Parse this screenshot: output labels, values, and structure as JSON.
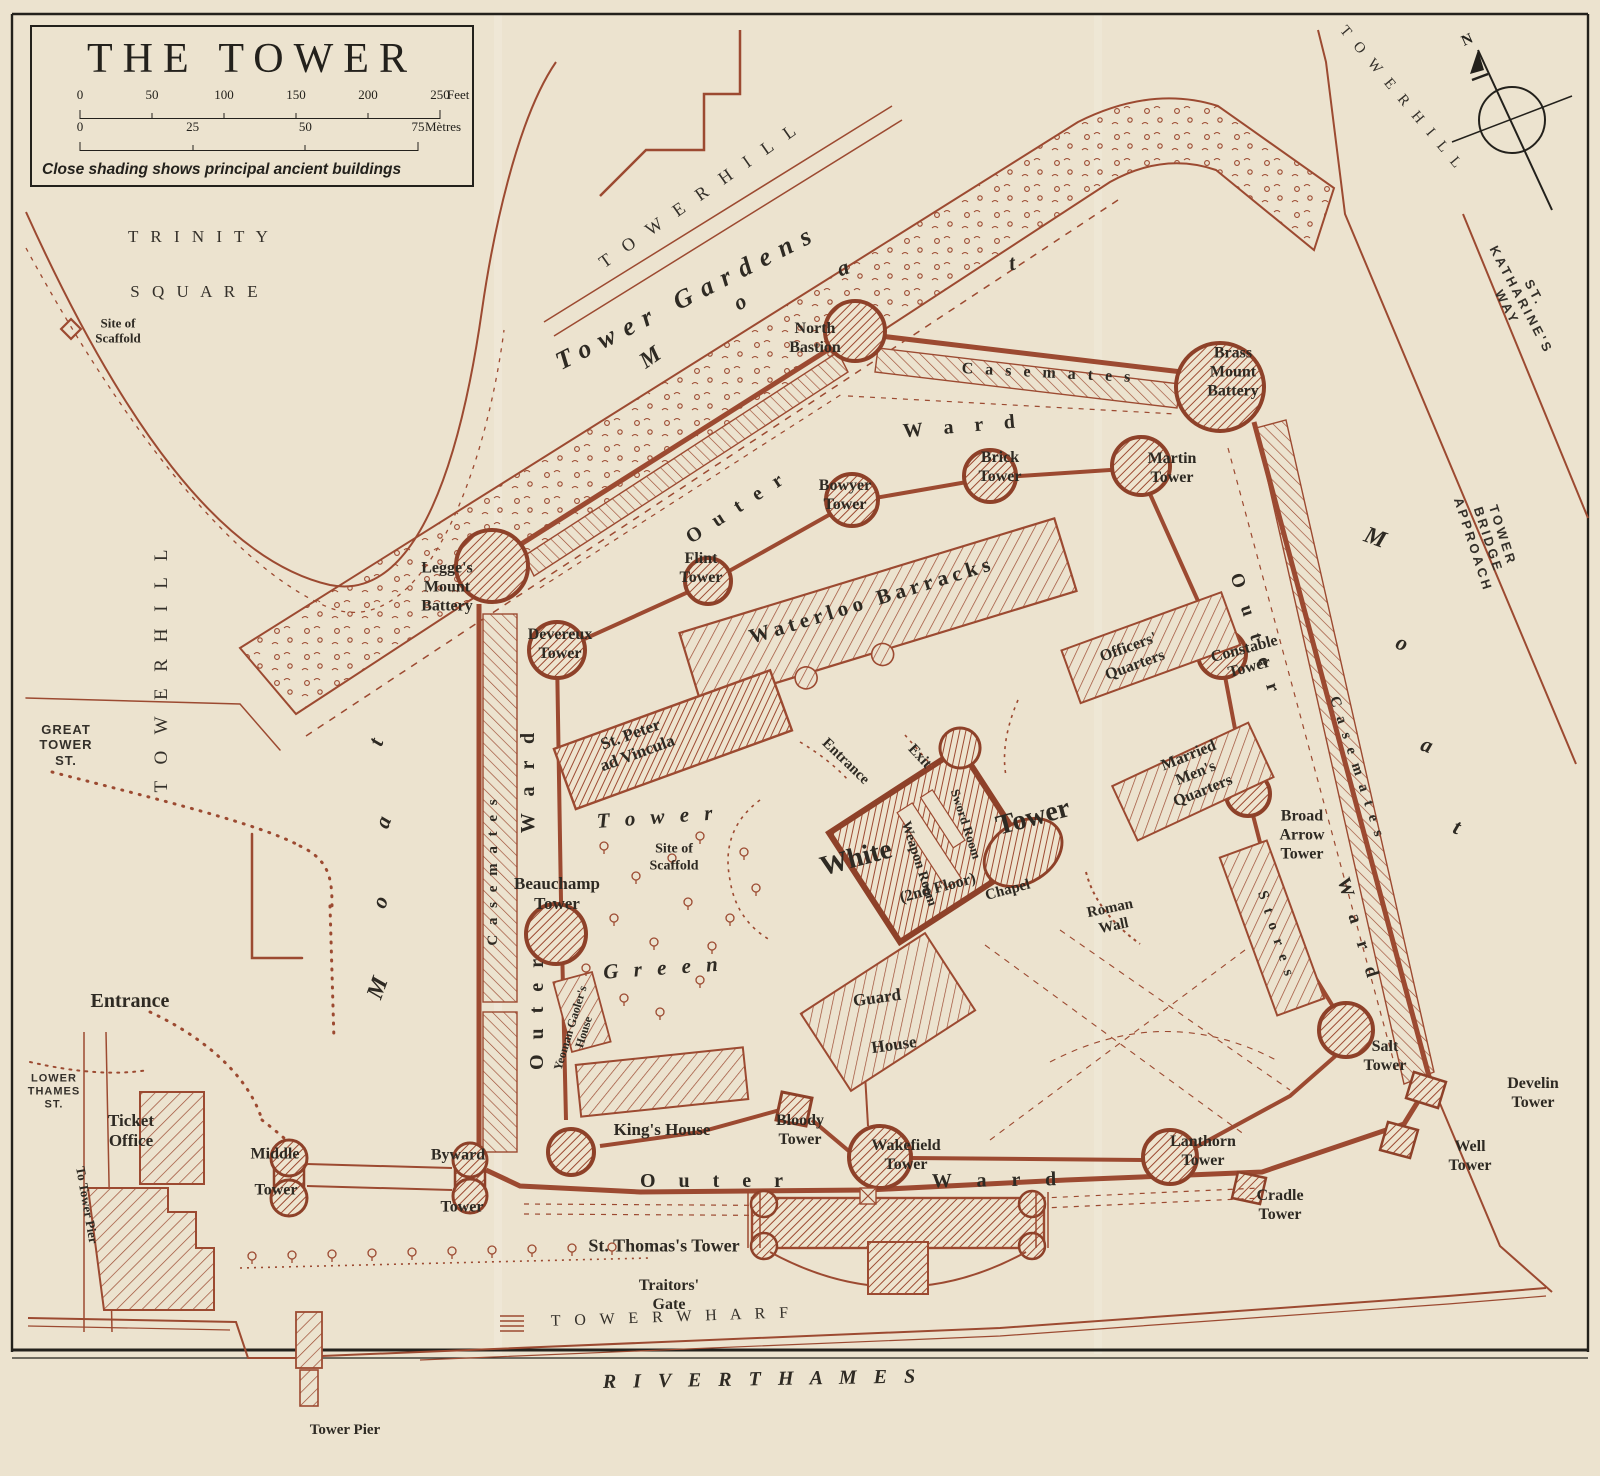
{
  "title_block": {
    "title": "THE TOWER",
    "feet_ticks": [
      "0",
      "50",
      "100",
      "150",
      "200",
      "250"
    ],
    "feet_unit": "Feet",
    "metre_ticks": [
      "0",
      "25",
      "50",
      "75"
    ],
    "metre_unit": "Mètres",
    "legend": "Close shading shows principal ancient buildings"
  },
  "compass": {
    "north": "N"
  },
  "colors": {
    "paper": "#ece3cf",
    "map_ink": "#9c4a31",
    "label_ink": "#2e2a23",
    "frame_ink": "#23211c"
  },
  "map": {
    "labels": [
      {
        "id": "trinity-square-line1",
        "text": "T R I N I T Y",
        "x": 200,
        "y": 237,
        "rot": 0,
        "size": 17,
        "cls": "caps",
        "ls": 4
      },
      {
        "id": "trinity-square-line2",
        "text": "S Q U A R E",
        "x": 196,
        "y": 292,
        "rot": 0,
        "size": 17,
        "cls": "caps",
        "ls": 4
      },
      {
        "id": "tower-hill-west",
        "text": "T O W E R    H I L L",
        "x": 162,
        "y": 668,
        "rot": -90,
        "size": 19,
        "cls": "caps",
        "ls": 6
      },
      {
        "id": "tower-hill-northwest",
        "text": "T O W E R   H I L L",
        "x": 700,
        "y": 195,
        "rot": -35,
        "size": 18,
        "cls": "caps",
        "ls": 6
      },
      {
        "id": "tower-hill-northeast",
        "text": "T O W E R   H I L L",
        "x": 1401,
        "y": 99,
        "rot": 50,
        "size": 15,
        "cls": "caps",
        "ls": 4
      },
      {
        "id": "st-katharines-way",
        "text": "ST. KATHARINE'S WAY",
        "x": 1521,
        "y": 300,
        "rot": 62,
        "size": 13,
        "cls": "sans",
        "ls": 3
      },
      {
        "id": "tower-bridge-approach",
        "text": "TOWER BRIDGE APPROACH",
        "x": 1488,
        "y": 540,
        "rot": 72,
        "size": 13,
        "cls": "sans",
        "ls": 3
      },
      {
        "id": "tower-wharf",
        "text": "T O W E R    W H A R F",
        "x": 672,
        "y": 1318,
        "rot": -2,
        "size": 16,
        "cls": "caps",
        "ls": 5
      },
      {
        "id": "river-thames",
        "text": "R I V E R     T H A M E S",
        "x": 762,
        "y": 1380,
        "rot": -1,
        "size": 20,
        "cls": "itcaps",
        "ls": 6
      },
      {
        "id": "great-tower-st",
        "text": "GREAT\nTOWER\nST.",
        "x": 66,
        "y": 745,
        "rot": 0,
        "size": 13,
        "cls": "sans",
        "ls": 1
      },
      {
        "id": "lower-thames-st",
        "text": "LOWER\nTHAMES\nST.",
        "x": 54,
        "y": 1092,
        "rot": 0,
        "size": 11,
        "cls": "sans",
        "ls": 1
      },
      {
        "id": "tower-gardens",
        "text": "Tower Gardens",
        "x": 688,
        "y": 297,
        "rot": -27,
        "size": 26,
        "cls": "it",
        "ls": 10
      },
      {
        "id": "moat-north-m",
        "text": "M",
        "x": 650,
        "y": 357,
        "rot": -35,
        "size": 23,
        "cls": "it"
      },
      {
        "id": "moat-north-o",
        "text": "o",
        "x": 740,
        "y": 302,
        "rot": -30,
        "size": 22,
        "cls": "it"
      },
      {
        "id": "moat-north-a",
        "text": "a",
        "x": 843,
        "y": 268,
        "rot": -20,
        "size": 22,
        "cls": "it"
      },
      {
        "id": "moat-north-t",
        "text": "t",
        "x": 1012,
        "y": 263,
        "rot": -10,
        "size": 22,
        "cls": "it"
      },
      {
        "id": "moat-west-t",
        "text": "t",
        "x": 376,
        "y": 742,
        "rot": -70,
        "size": 22,
        "cls": "it"
      },
      {
        "id": "moat-west-a",
        "text": "a",
        "x": 383,
        "y": 822,
        "rot": -70,
        "size": 22,
        "cls": "it"
      },
      {
        "id": "moat-west-o",
        "text": "o",
        "x": 380,
        "y": 902,
        "rot": -70,
        "size": 22,
        "cls": "it"
      },
      {
        "id": "moat-west-m",
        "text": "M",
        "x": 378,
        "y": 988,
        "rot": -70,
        "size": 24,
        "cls": "it"
      },
      {
        "id": "moat-east-m",
        "text": "M",
        "x": 1375,
        "y": 538,
        "rot": 20,
        "size": 24,
        "cls": "it"
      },
      {
        "id": "moat-east-o",
        "text": "o",
        "x": 1402,
        "y": 643,
        "rot": 20,
        "size": 22,
        "cls": "it"
      },
      {
        "id": "moat-east-a",
        "text": "a",
        "x": 1427,
        "y": 745,
        "rot": 20,
        "size": 22,
        "cls": "it"
      },
      {
        "id": "moat-east-t",
        "text": "t",
        "x": 1457,
        "y": 827,
        "rot": 20,
        "size": 22,
        "cls": "it"
      },
      {
        "id": "tower-green-word1",
        "text": "T o w e r",
        "x": 657,
        "y": 817,
        "rot": -4,
        "size": 21,
        "cls": "it",
        "ls": 5
      },
      {
        "id": "tower-green-word2",
        "text": "G r e e n",
        "x": 663,
        "y": 968,
        "rot": -4,
        "size": 21,
        "cls": "it",
        "ls": 5
      },
      {
        "id": "outer-ward-north-outer",
        "text": "O u t e r",
        "x": 737,
        "y": 508,
        "rot": -33,
        "size": 20,
        "cls": "sp",
        "ls": 5
      },
      {
        "id": "outer-ward-north-ward",
        "text": "W a r d",
        "x": 963,
        "y": 427,
        "rot": -5,
        "size": 20,
        "cls": "sp",
        "ls": 8
      },
      {
        "id": "outer-ward-west-ward",
        "text": "W a r d",
        "x": 529,
        "y": 780,
        "rot": -90,
        "size": 20,
        "cls": "sp",
        "ls": 6
      },
      {
        "id": "outer-ward-west-outer",
        "text": "O u t e r",
        "x": 538,
        "y": 1012,
        "rot": -90,
        "size": 20,
        "cls": "sp",
        "ls": 5
      },
      {
        "id": "outer-ward-south-outer",
        "text": "O u t e r",
        "x": 716,
        "y": 1182,
        "rot": 0,
        "size": 20,
        "cls": "sp",
        "ls": 9
      },
      {
        "id": "outer-ward-south-ward",
        "text": "W a r d",
        "x": 999,
        "y": 1181,
        "rot": -1,
        "size": 20,
        "cls": "sp",
        "ls": 10
      },
      {
        "id": "outer-ward-east-outer",
        "text": "O u t e r",
        "x": 1255,
        "y": 636,
        "rot": 72,
        "size": 19,
        "cls": "sp",
        "ls": 7
      },
      {
        "id": "outer-ward-east-ward",
        "text": "W a r d",
        "x": 1358,
        "y": 931,
        "rot": 73,
        "size": 19,
        "cls": "sp",
        "ls": 7
      },
      {
        "id": "casemates-north",
        "text": "C a s e m a t e s",
        "x": 1048,
        "y": 374,
        "rot": 3,
        "size": 16,
        "cls": "sp",
        "ls": 4
      },
      {
        "id": "casemates-west",
        "text": "C a s e m a t e s",
        "x": 494,
        "y": 871,
        "rot": -90,
        "size": 15,
        "cls": "sp",
        "ls": 3
      },
      {
        "id": "casemates-east",
        "text": "C a s e m a t e s",
        "x": 1356,
        "y": 768,
        "rot": 72,
        "size": 15,
        "cls": "sp",
        "ls": 3
      },
      {
        "id": "stores",
        "text": "S t o r e s",
        "x": 1275,
        "y": 935,
        "rot": 72,
        "size": 15,
        "cls": "sp",
        "ls": 3
      },
      {
        "id": "site-of-scaffold-trinity",
        "text": "Site of\nScaffold",
        "x": 118,
        "y": 331,
        "rot": 0,
        "size": 13,
        "cls": "sm"
      },
      {
        "id": "north-bastion",
        "text": "North\nBastion",
        "x": 815,
        "y": 339,
        "rot": 0,
        "size": 16,
        "cls": "nm"
      },
      {
        "id": "brass-mount-battery",
        "text": "Brass\nMount\nBattery",
        "x": 1233,
        "y": 373,
        "rot": 0,
        "size": 16,
        "cls": "nm"
      },
      {
        "id": "legges-mount-battery",
        "text": "Legge's\nMount\nBattery",
        "x": 447,
        "y": 588,
        "rot": 0,
        "size": 16,
        "cls": "nm"
      },
      {
        "id": "devereux-tower",
        "text": "Devereux\nTower",
        "x": 560,
        "y": 645,
        "rot": 0,
        "size": 16,
        "cls": "nm"
      },
      {
        "id": "flint-tower",
        "text": "Flint\nTower",
        "x": 701,
        "y": 569,
        "rot": 0,
        "size": 16,
        "cls": "nm"
      },
      {
        "id": "bowyer-tower",
        "text": "Bowyer\nTower",
        "x": 845,
        "y": 496,
        "rot": 0,
        "size": 16,
        "cls": "nm"
      },
      {
        "id": "brick-tower",
        "text": "Brick\nTower",
        "x": 1000,
        "y": 468,
        "rot": 0,
        "size": 16,
        "cls": "nm"
      },
      {
        "id": "martin-tower",
        "text": "Martin\nTower",
        "x": 1172,
        "y": 469,
        "rot": 0,
        "size": 16,
        "cls": "nm"
      },
      {
        "id": "waterloo-barracks",
        "text": "Waterloo   Barracks",
        "x": 872,
        "y": 600,
        "rot": -17,
        "size": 21,
        "cls": "nm",
        "ls": 5
      },
      {
        "id": "officers-quarters",
        "text": "Officers'\nQuarters",
        "x": 1132,
        "y": 657,
        "rot": -20,
        "size": 16,
        "cls": "nm"
      },
      {
        "id": "constable-tower",
        "text": "Constable\nTower",
        "x": 1247,
        "y": 659,
        "rot": -15,
        "size": 16,
        "cls": "nm"
      },
      {
        "id": "married-mens-quarters",
        "text": "Married\nMen's\nQuarters",
        "x": 1196,
        "y": 774,
        "rot": -22,
        "size": 16,
        "cls": "nm"
      },
      {
        "id": "broad-arrow-tower",
        "text": "Broad\nArrow\nTower",
        "x": 1302,
        "y": 836,
        "rot": 0,
        "size": 16,
        "cls": "nm"
      },
      {
        "id": "roman-wall",
        "text": "Roman\nWall",
        "x": 1112,
        "y": 918,
        "rot": -12,
        "size": 15,
        "cls": "nm"
      },
      {
        "id": "st-peter-ad-vincula",
        "text": "St. Peter\nad Vincula",
        "x": 634,
        "y": 744,
        "rot": -20,
        "size": 17,
        "cls": "nm"
      },
      {
        "id": "beauchamp-tower",
        "text": "Beauchamp\nTower",
        "x": 557,
        "y": 894,
        "rot": 0,
        "size": 17,
        "cls": "nm"
      },
      {
        "id": "site-of-scaffold-green",
        "text": "Site of\nScaffold",
        "x": 674,
        "y": 858,
        "rot": 0,
        "size": 14,
        "cls": "sm"
      },
      {
        "id": "yeoman-gaolers-house",
        "text": "Yeoman Gaoler's\nHouse",
        "x": 577,
        "y": 1030,
        "rot": -73,
        "size": 12,
        "cls": "sm"
      },
      {
        "id": "white-tower-word1",
        "text": "White",
        "x": 856,
        "y": 858,
        "rot": -15,
        "size": 28,
        "cls": "nm"
      },
      {
        "id": "white-tower-word2",
        "text": "Tower",
        "x": 1033,
        "y": 817,
        "rot": -15,
        "size": 28,
        "cls": "nm"
      },
      {
        "id": "white-tower-floor",
        "text": "(2nd Floor)",
        "x": 938,
        "y": 889,
        "rot": -15,
        "size": 16,
        "cls": "nm"
      },
      {
        "id": "weapon-room",
        "text": "Weapon Room",
        "x": 918,
        "y": 864,
        "rot": 72,
        "size": 14,
        "cls": "sm"
      },
      {
        "id": "sword-room",
        "text": "Sword Room",
        "x": 966,
        "y": 824,
        "rot": 72,
        "size": 13,
        "cls": "sm"
      },
      {
        "id": "chapel",
        "text": "Chapel",
        "x": 1008,
        "y": 891,
        "rot": -15,
        "size": 15,
        "cls": "nm"
      },
      {
        "id": "white-tower-entrance",
        "text": "Entrance",
        "x": 845,
        "y": 762,
        "rot": 44,
        "size": 15,
        "cls": "nm"
      },
      {
        "id": "white-tower-exit",
        "text": "Exit",
        "x": 919,
        "y": 757,
        "rot": 47,
        "size": 15,
        "cls": "nm"
      },
      {
        "id": "guard-house-word1",
        "text": "Guard",
        "x": 877,
        "y": 998,
        "rot": -8,
        "size": 17,
        "cls": "nm"
      },
      {
        "id": "guard-house-word2",
        "text": "House",
        "x": 894,
        "y": 1045,
        "rot": -8,
        "size": 17,
        "cls": "nm"
      },
      {
        "id": "kings-house",
        "text": "King's House",
        "x": 662,
        "y": 1130,
        "rot": 0,
        "size": 17,
        "cls": "nm"
      },
      {
        "id": "bloody-tower",
        "text": "Bloody\nTower",
        "x": 800,
        "y": 1131,
        "rot": 0,
        "size": 16,
        "cls": "nm"
      },
      {
        "id": "wakefield-tower",
        "text": "Wakefield\nTower",
        "x": 906,
        "y": 1156,
        "rot": 0,
        "size": 16,
        "cls": "nm"
      },
      {
        "id": "lanthorn-tower",
        "text": "Lanthorn\nTower",
        "x": 1203,
        "y": 1152,
        "rot": 0,
        "size": 16,
        "cls": "nm"
      },
      {
        "id": "salt-tower",
        "text": "Salt\nTower",
        "x": 1385,
        "y": 1057,
        "rot": 0,
        "size": 16,
        "cls": "nm"
      },
      {
        "id": "develin-tower",
        "text": "Develin\nTower",
        "x": 1533,
        "y": 1094,
        "rot": 0,
        "size": 16,
        "cls": "nm"
      },
      {
        "id": "well-tower",
        "text": "Well\nTower",
        "x": 1470,
        "y": 1157,
        "rot": 0,
        "size": 16,
        "cls": "nm"
      },
      {
        "id": "cradle-tower",
        "text": "Cradle\nTower",
        "x": 1280,
        "y": 1206,
        "rot": 0,
        "size": 16,
        "cls": "nm"
      },
      {
        "id": "st-thomass-tower",
        "text": "St. Thomas's Tower",
        "x": 664,
        "y": 1246,
        "rot": 0,
        "size": 18,
        "cls": "nm"
      },
      {
        "id": "traitors-gate",
        "text": "Traitors'\nGate",
        "x": 669,
        "y": 1296,
        "rot": 0,
        "size": 16,
        "cls": "nm"
      },
      {
        "id": "middle-tower-word1",
        "text": "Middle",
        "x": 275,
        "y": 1155,
        "rot": 0,
        "size": 16,
        "cls": "nm"
      },
      {
        "id": "middle-tower-word2",
        "text": "Tower",
        "x": 276,
        "y": 1191,
        "rot": 0,
        "size": 16,
        "cls": "nm"
      },
      {
        "id": "byward-tower-word1",
        "text": "Byward",
        "x": 458,
        "y": 1156,
        "rot": 0,
        "size": 16,
        "cls": "nm"
      },
      {
        "id": "byward-tower-word2",
        "text": "Tower",
        "x": 462,
        "y": 1208,
        "rot": 0,
        "size": 16,
        "cls": "nm"
      },
      {
        "id": "ticket-office",
        "text": "Ticket\nOffice",
        "x": 131,
        "y": 1131,
        "rot": 0,
        "size": 17,
        "cls": "nm"
      },
      {
        "id": "entrance-west",
        "text": "Entrance",
        "x": 130,
        "y": 1002,
        "rot": 0,
        "size": 20,
        "cls": "nm"
      },
      {
        "id": "to-tower-pier",
        "text": "To Tower Pier",
        "x": 87,
        "y": 1205,
        "rot": 80,
        "size": 13,
        "cls": "nm"
      },
      {
        "id": "tower-pier",
        "text": "Tower Pier",
        "x": 345,
        "y": 1431,
        "rot": 0,
        "size": 15,
        "cls": "nm"
      }
    ]
  }
}
